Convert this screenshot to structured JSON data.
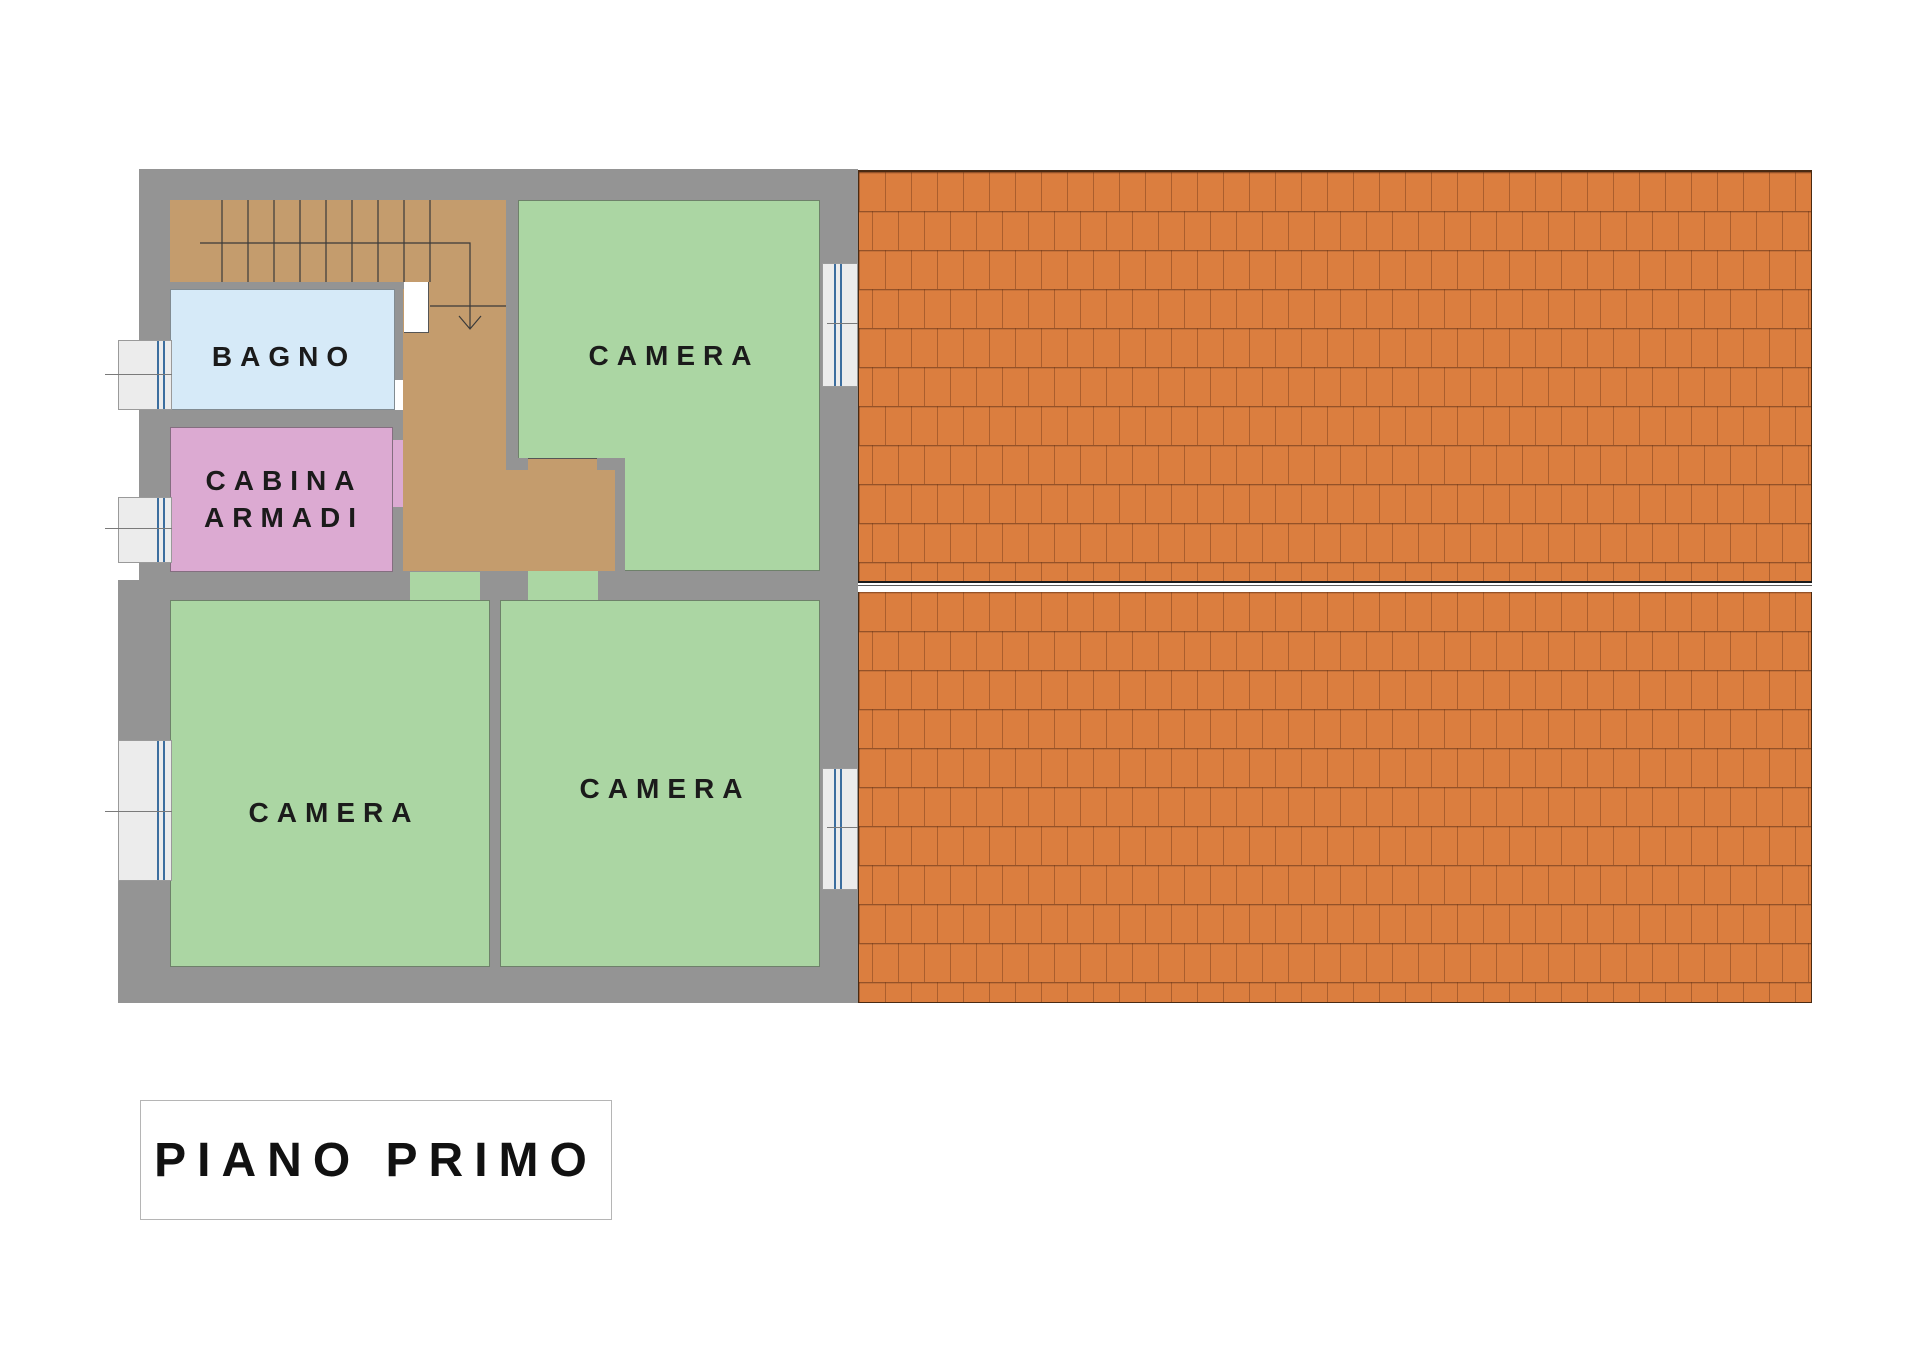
{
  "title": {
    "label": "PIANO PRIMO"
  },
  "rooms": {
    "bagno": {
      "label": "BAGNO"
    },
    "cabina_armadi": {
      "line1": "CABINA",
      "line2": "ARMADI"
    },
    "camera_top": {
      "label": "CAMERA"
    },
    "camera_bottom_left": {
      "label": "CAMERA"
    },
    "camera_bottom_middle": {
      "label": "CAMERA"
    }
  },
  "legend_colors": {
    "wall_gray": "#949494",
    "stairs_hall_tan": "#c49c6d",
    "bagno_blue": "#d6eaf8",
    "cabina_pink": "#dcaad2",
    "camera_green": "#abd6a3",
    "roof_tile_orange": "#db7e3f",
    "roof_line": "#7b3e1c",
    "window_glass_blue": "#3c6e9f",
    "ridge_band": "#ffffff"
  }
}
